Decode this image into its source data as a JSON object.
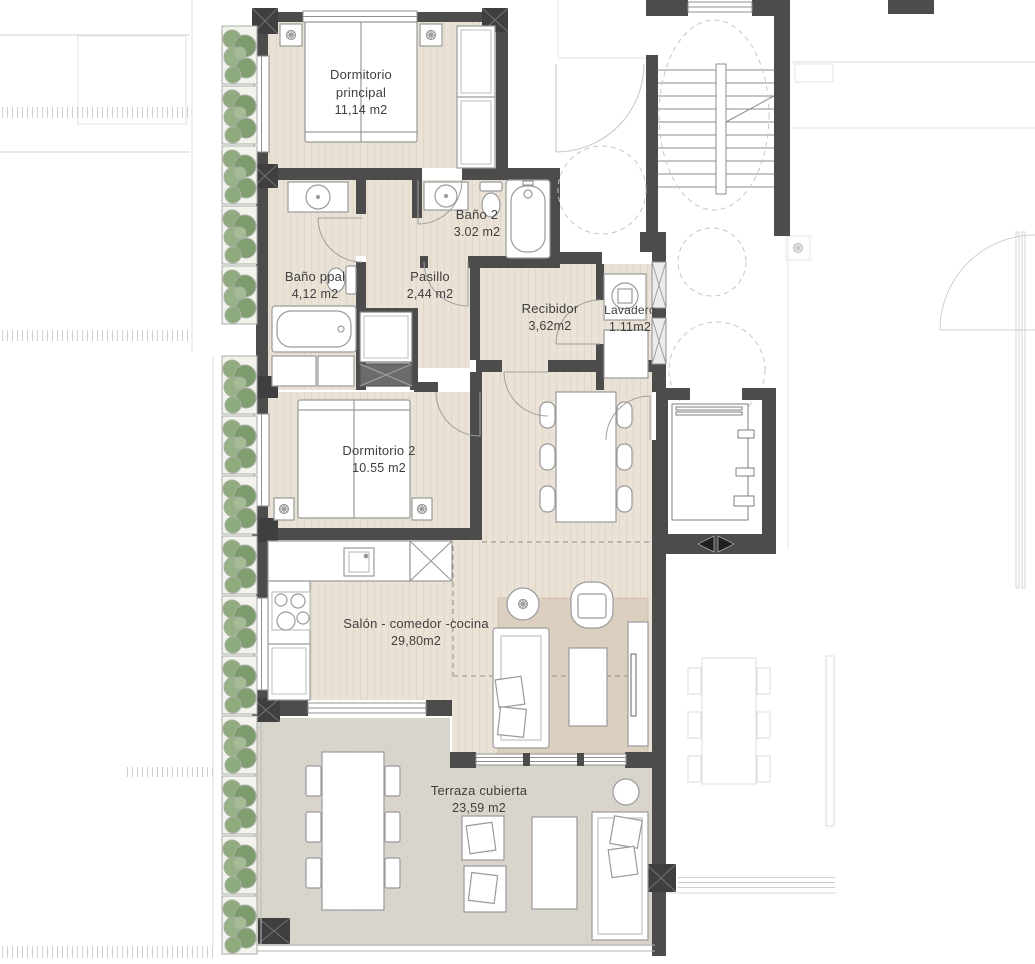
{
  "page": {
    "background": "#ffffff"
  },
  "rooms": {
    "dormitorio_principal": {
      "name": "Dormitorio principal",
      "area": "11,14 m2"
    },
    "bano_2": {
      "name": "Baño 2",
      "area": "3.02 m2"
    },
    "bano_ppal": {
      "name": "Baño ppal",
      "area": "4,12 m2"
    },
    "pasillo": {
      "name": "Pasillo",
      "area": "2,44 m2"
    },
    "recibidor": {
      "name": "Recibidor",
      "area": "3,62m2"
    },
    "lavadero": {
      "name": "Lavadero",
      "area": "1.11m2"
    },
    "dormitorio_2": {
      "name": "Dormitorio 2",
      "area": "10.55 m2"
    },
    "salon_comedor_cocina": {
      "name": "Salón - comedor -cocina",
      "area": "29,80m2"
    },
    "terraza_cubierta": {
      "name": "Terraza cubierta",
      "area": "23,59 m2"
    }
  },
  "colors": {
    "wall": "#4c4c4c",
    "pillar": "#3f3f3f",
    "floor_wood": "#eae2d6",
    "floor_terrace": "#d9d5cc",
    "rug": "#ddcfc0",
    "planter_green": "#8aa87c",
    "furniture_outline": "#9a9a9a",
    "context_gray": "#d8d8d8",
    "label_text": "#3f3f3f"
  }
}
